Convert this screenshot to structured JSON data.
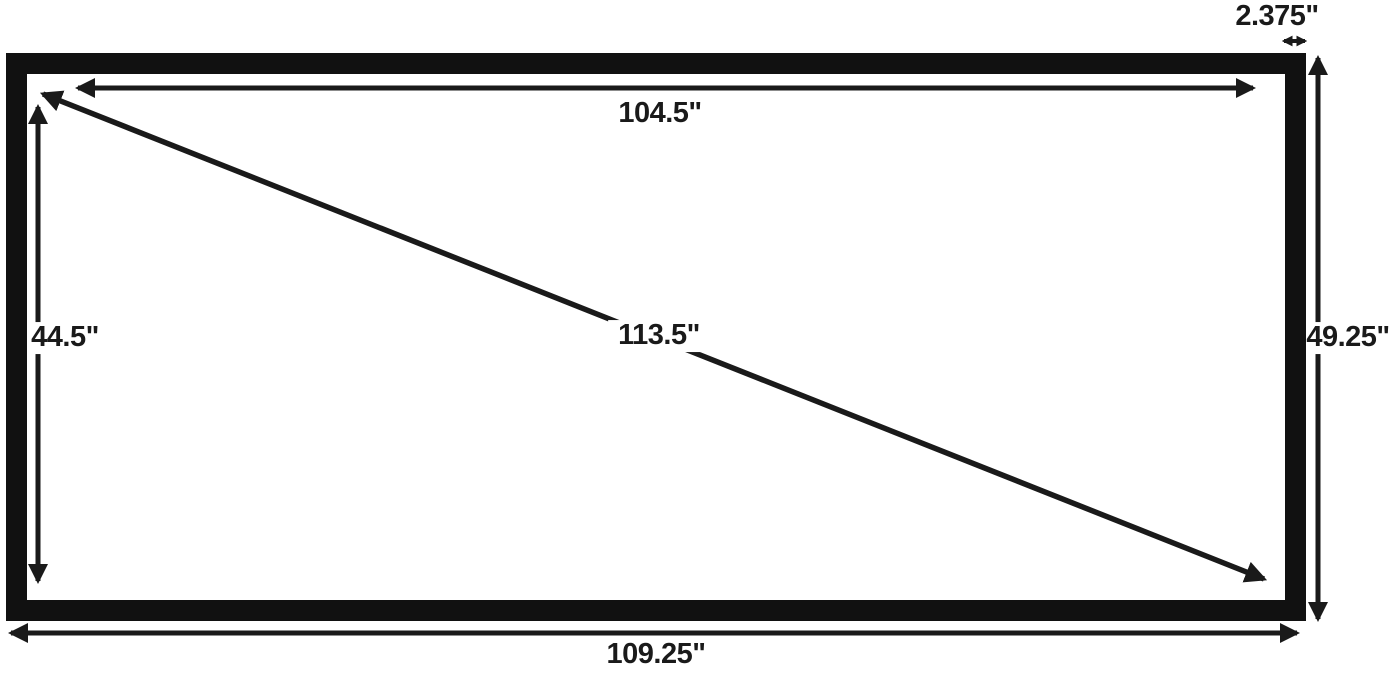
{
  "diagram": {
    "measurements": {
      "inner_width": "104.5\"",
      "inner_height": "44.5\"",
      "diagonal": "113.5\"",
      "outer_width": "109.25\"",
      "outer_height": "49.25\"",
      "frame_border_width": "2.375\""
    },
    "colors": {
      "frame": "#111111",
      "lines": "#1a1a1a",
      "background": "#ffffff"
    }
  }
}
